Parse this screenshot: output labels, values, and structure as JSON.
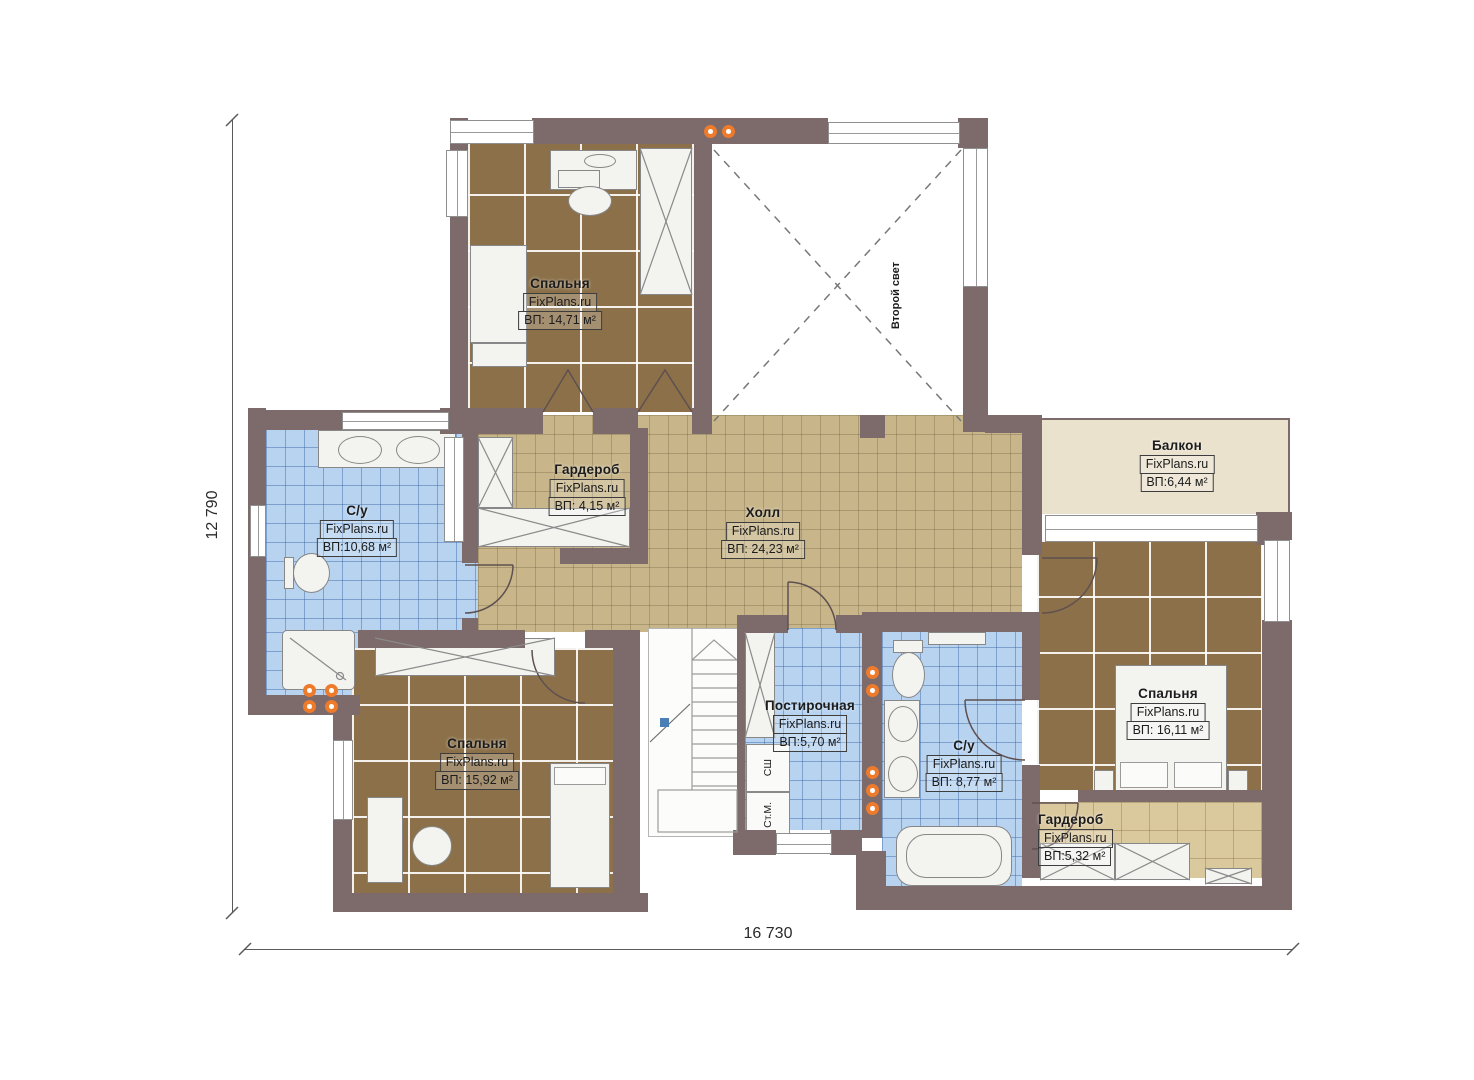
{
  "dimensions": {
    "height_label": "12 790",
    "width_label": "16 730"
  },
  "void_space": {
    "label": "Второй свет"
  },
  "appliances": {
    "dryer": "СШ",
    "washer": "Ст.М."
  },
  "watermark": "FixPlans.ru",
  "rooms": {
    "bedroom_top": {
      "name": "Спальня",
      "watermark": "FixPlans.ru",
      "area": "ВП: 14,71 м²"
    },
    "wardrobe_top": {
      "name": "Гардероб",
      "watermark": "FixPlans.ru",
      "area": "ВП: 4,15 м²"
    },
    "bath_left": {
      "name": "С/у",
      "watermark": "FixPlans.ru",
      "area": "ВП:10,68 м²"
    },
    "hall": {
      "name": "Холл",
      "watermark": "FixPlans.ru",
      "area": "ВП: 24,23 м²"
    },
    "balcony": {
      "name": "Балкон",
      "watermark": "FixPlans.ru",
      "area": "ВП:6,44 м²"
    },
    "bedroom_right": {
      "name": "Спальня",
      "watermark": "FixPlans.ru",
      "area": "ВП: 16,11 м²"
    },
    "wardrobe_right": {
      "name": "Гардероб",
      "watermark": "FixPlans.ru",
      "area": "ВП:5,32 м²"
    },
    "bedroom_bottom": {
      "name": "Спальня",
      "watermark": "FixPlans.ru",
      "area": "ВП: 15,92 м²"
    },
    "laundry": {
      "name": "Постирочная",
      "watermark": "FixPlans.ru",
      "area": "ВП:5,70 м²"
    },
    "bath_right": {
      "name": "С/у",
      "watermark": "FixPlans.ru",
      "area": "ВП: 8,77 м²"
    }
  },
  "colors": {
    "wall": "#7d6b6b",
    "floor_brown": "#8b7049",
    "floor_tan": "#c8b68a",
    "floor_blue": "#b7d3f0",
    "floor_cream": "#ebe2cd",
    "floor_light_tan": "#dbc99e",
    "riser_orange": "#ee7a2b"
  }
}
